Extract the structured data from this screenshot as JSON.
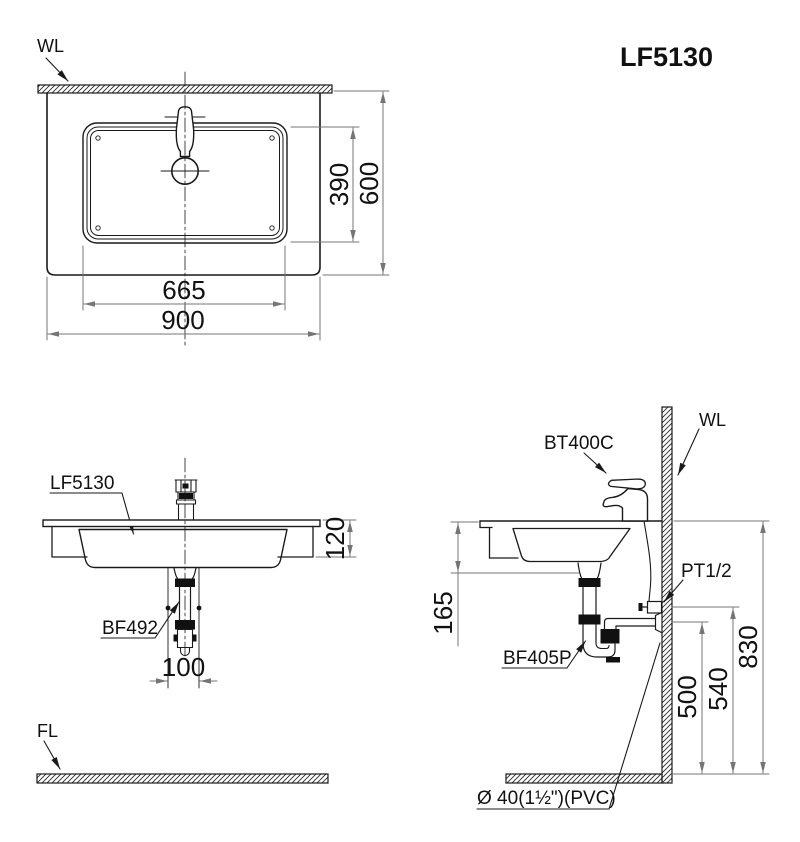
{
  "title": "LF5130",
  "views": {
    "plan": {
      "wall_label": "WL",
      "dims": {
        "basin_width": "665",
        "counter_width": "900",
        "basin_depth": "390",
        "counter_depth": "600"
      }
    },
    "front": {
      "product_label": "LF5130",
      "drain_label": "BF492",
      "floor_label": "FL",
      "dims": {
        "basin_height": "120",
        "drain_offset": "100"
      }
    },
    "side": {
      "faucet_label": "BT400C",
      "wall_label": "WL",
      "supply_label": "PT1/2",
      "trap_label": "BF405P",
      "outlet_label": "Ø 40(1½\")(PVC)",
      "dims": {
        "counter_to_trap": "165",
        "counter_to_floor": "830",
        "valve_height": "540",
        "drain_height": "500"
      }
    }
  },
  "colors": {
    "object_line": "#1a1a1a",
    "dimension_line": "#757575",
    "background": "#ffffff"
  }
}
